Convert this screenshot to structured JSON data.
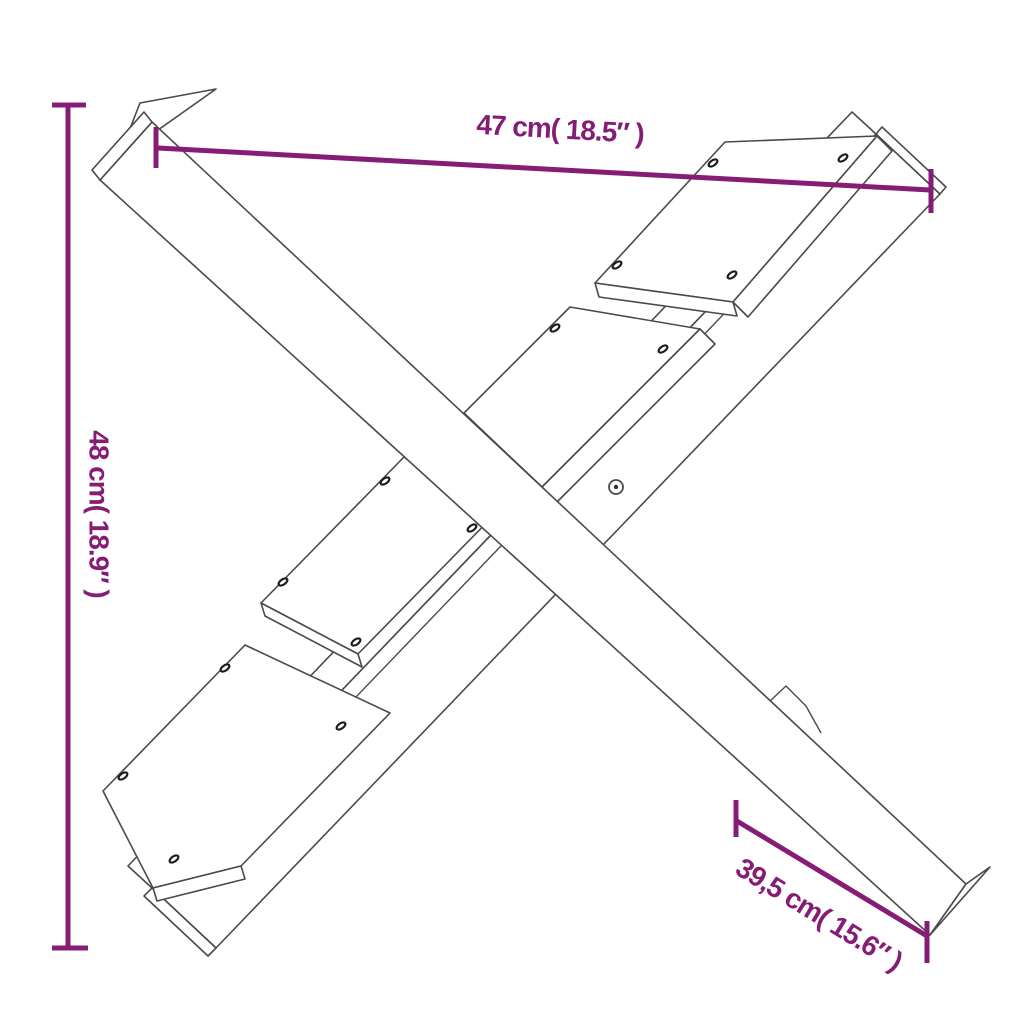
{
  "page": {
    "background": "#ffffff"
  },
  "diagram": {
    "type": "product-dimension-drawing",
    "subject": "x-shaped-log-holder-line-art",
    "line_color": "#4a4a4a",
    "accent_color": "#851C75",
    "dimensions": {
      "width": {
        "label": "47 cm( 18.5″ )",
        "placement": "top-horizontal"
      },
      "height": {
        "label": "48 cm( 18.9″ )",
        "placement": "left-vertical-rotated"
      },
      "depth": {
        "label": "39,5 cm( 15.6″ )",
        "placement": "bottom-right-diagonal"
      }
    },
    "icons": {
      "fastener": "screw-ellipse-icon",
      "pivot": "bolt-circle-icon"
    },
    "fastener_count": 14,
    "pivot_count": 1
  }
}
